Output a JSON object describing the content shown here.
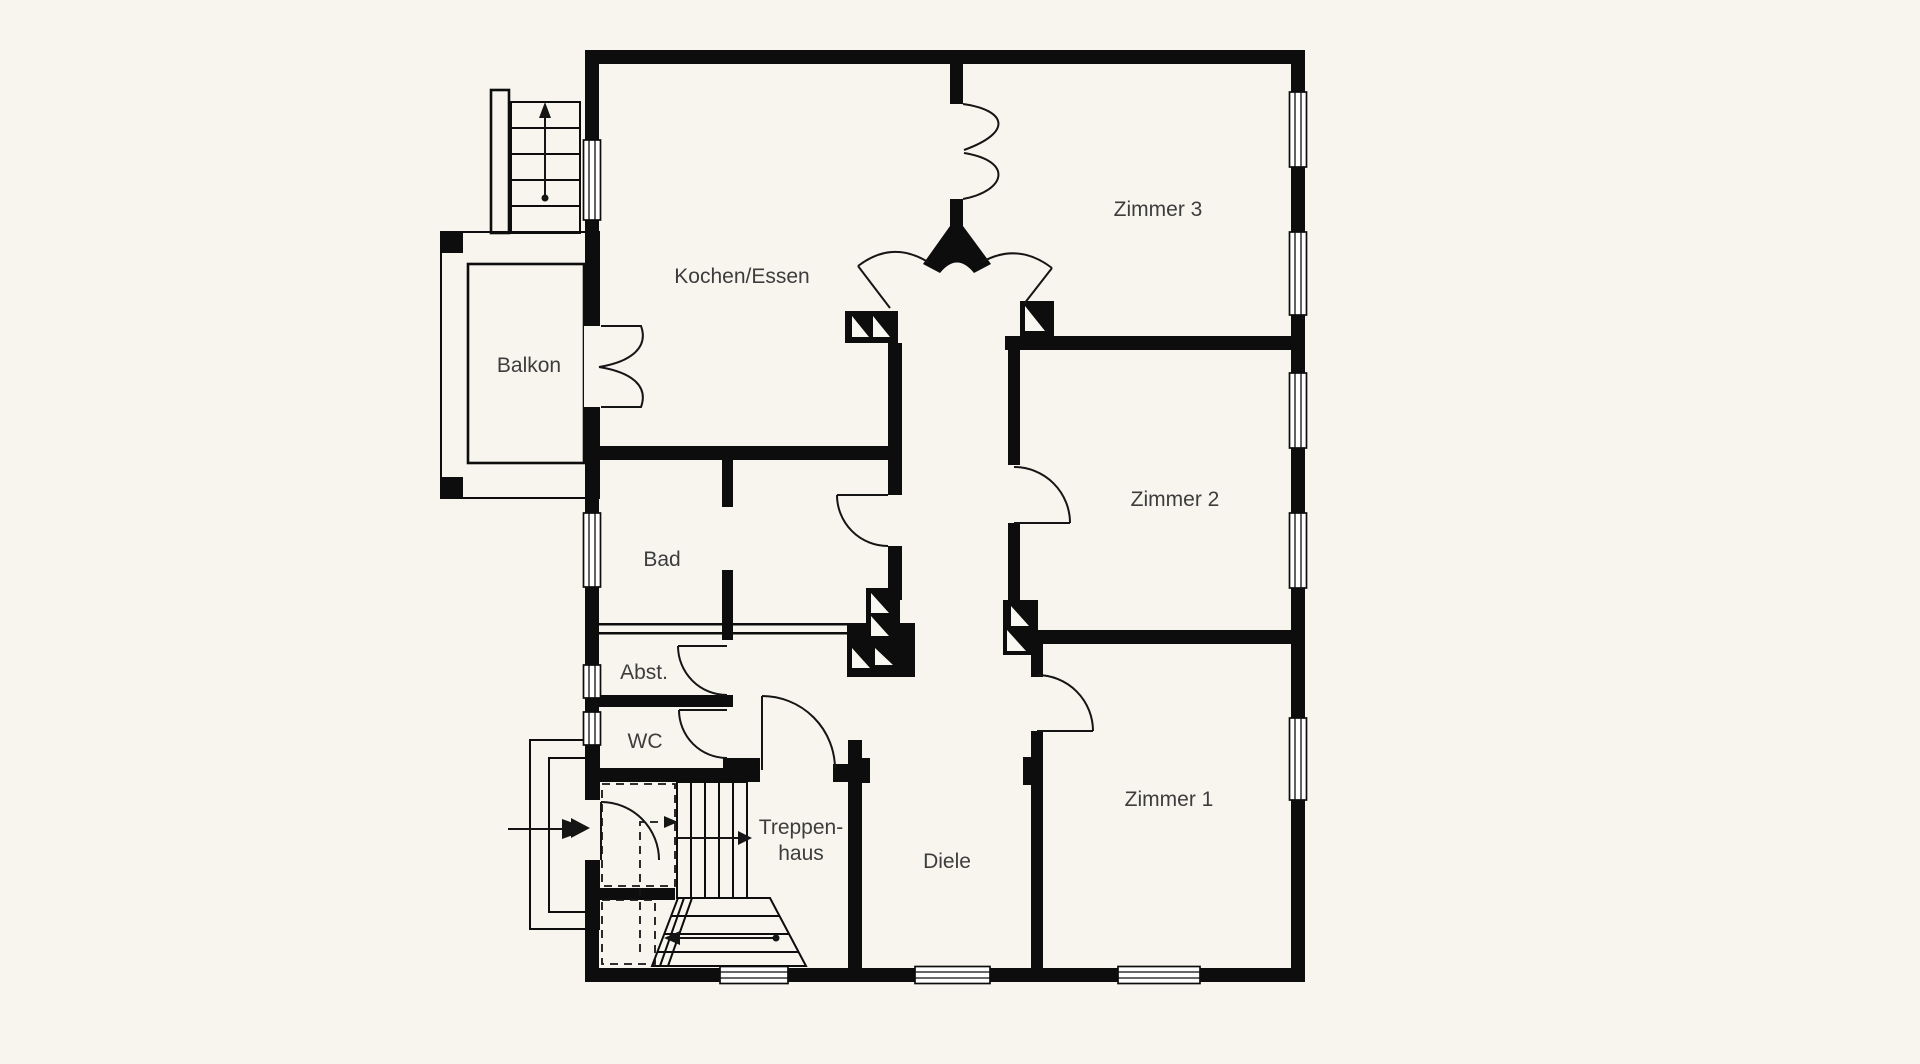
{
  "floor_plan": {
    "type": "apartment-floor-plan",
    "background_color": "#f7f5ee",
    "wall_color": "#0d0d0d",
    "label_color": "#3d3d3d",
    "rooms": {
      "kochen_essen": "Kochen/Essen",
      "zimmer3": "Zimmer 3",
      "zimmer2": "Zimmer 2",
      "zimmer1": "Zimmer 1",
      "balkon": "Balkon",
      "bad": "Bad",
      "abst": "Abst.",
      "wc": "WC",
      "diele": "Diele",
      "treppenhaus_line1": "Treppen-",
      "treppenhaus_line2": "haus"
    }
  }
}
